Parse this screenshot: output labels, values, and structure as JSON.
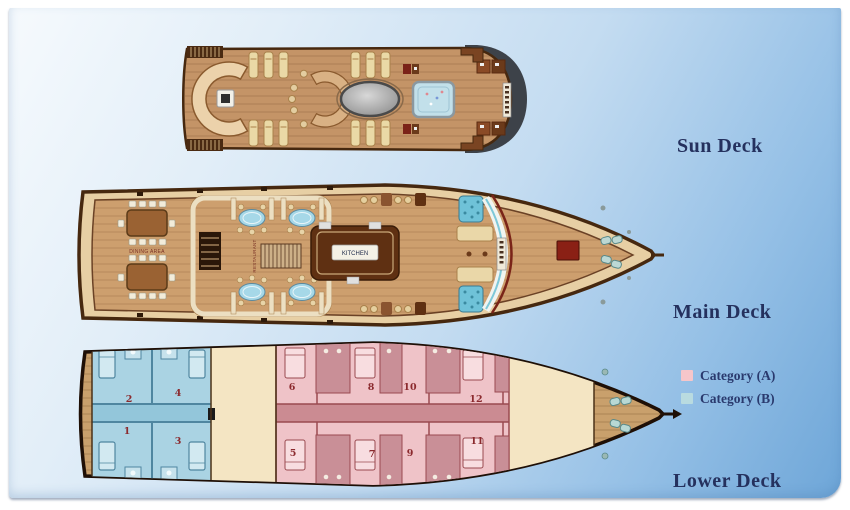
{
  "legend": {
    "items": [
      {
        "label": "Category (A)",
        "color": "#f6c6ca"
      },
      {
        "label": "Category (B)",
        "color": "#b9dbe0"
      }
    ]
  },
  "decks": {
    "sun": {
      "label": "Sun Deck"
    },
    "main": {
      "label": "Main Deck",
      "rooms": {
        "dining": "DINING AREA",
        "restaurant": "RESTAURANT",
        "kitchen": "KITCHEN"
      }
    },
    "lower": {
      "label": "Lower Deck",
      "cabins": {
        "c1": "1",
        "c2": "2",
        "c3": "3",
        "c4": "4",
        "c5": "5",
        "c6": "6",
        "c7": "7",
        "c8": "8",
        "c9": "9",
        "c10": "10",
        "c11": "11",
        "c12": "12"
      },
      "categories": {
        "a_label": "Category (A)",
        "a_cabins": [
          "5",
          "6",
          "7",
          "8",
          "9",
          "10",
          "11",
          "12"
        ],
        "b_label": "Category (B)",
        "b_cabins": [
          "1",
          "2",
          "3",
          "4"
        ]
      }
    }
  },
  "colors": {
    "category_a_pink": "#efc3c8",
    "category_b_blue": "#aad3e3",
    "deck_wood": "#c89a6a",
    "hull_outline": "#46280f",
    "label_text": "#25315e",
    "background_top": "#f6fafd",
    "background_bottom": "#6ea6d8"
  }
}
